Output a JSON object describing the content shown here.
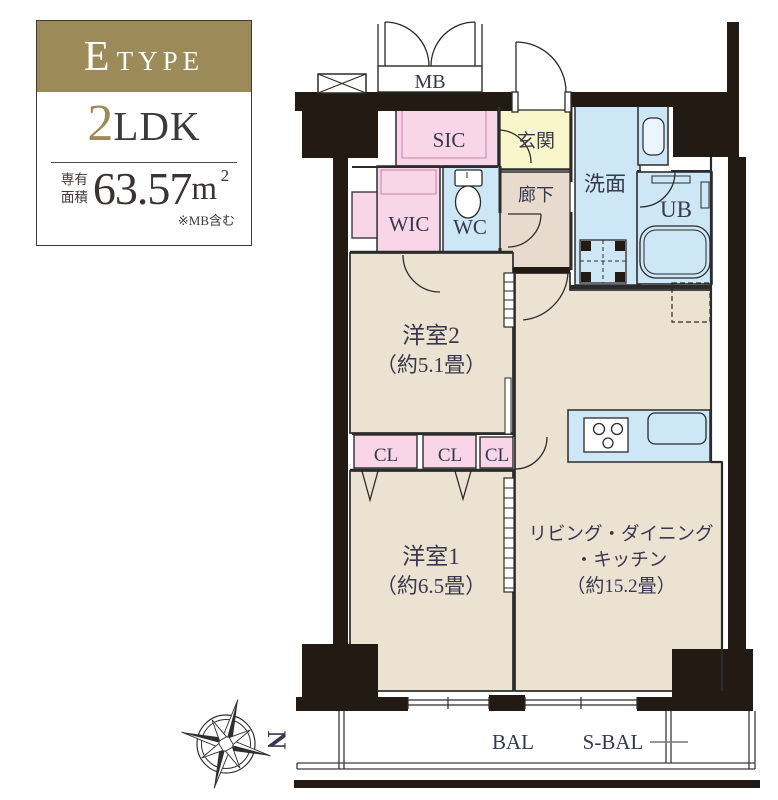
{
  "info_panel": {
    "type_letter": "E",
    "type_word": "TYPE",
    "layout_number": "2",
    "layout_letters": "LDK",
    "area_label_top": "専有",
    "area_label_bottom": "面積",
    "area_value": "63.57",
    "area_unit_base": "m",
    "area_unit_sup": "2",
    "area_note": "※MB含む"
  },
  "floorplan": {
    "rooms": {
      "mb": "MB",
      "sic": "SIC",
      "entrance": "玄関",
      "hallway": "廊下",
      "washroom": "洗面",
      "bath": "UB",
      "wic": "WIC",
      "toilet": "WC",
      "bedroom2": "洋室2",
      "bedroom2_size": "（約5.1畳）",
      "closet1": "CL",
      "closet2": "CL",
      "closet3": "CL",
      "bedroom1": "洋室1",
      "bedroom1_size": "（約6.5畳）",
      "ldk_line1": "リビング・ダイニング",
      "ldk_line2": "・キッチン",
      "ldk_line3": "（約15.2畳）",
      "balcony": "BAL",
      "service_balcony": "S-BAL"
    },
    "compass_north": "N"
  },
  "colors": {
    "gold": "#9c8a58",
    "room_beige": "#ece2d1",
    "hall_tan": "#e8dacc",
    "closet_pink": "#f8d6e7",
    "entrance_yellow": "#faf6cb",
    "wet_blue": "#cde7f7",
    "wall_black": "#241a14"
  }
}
